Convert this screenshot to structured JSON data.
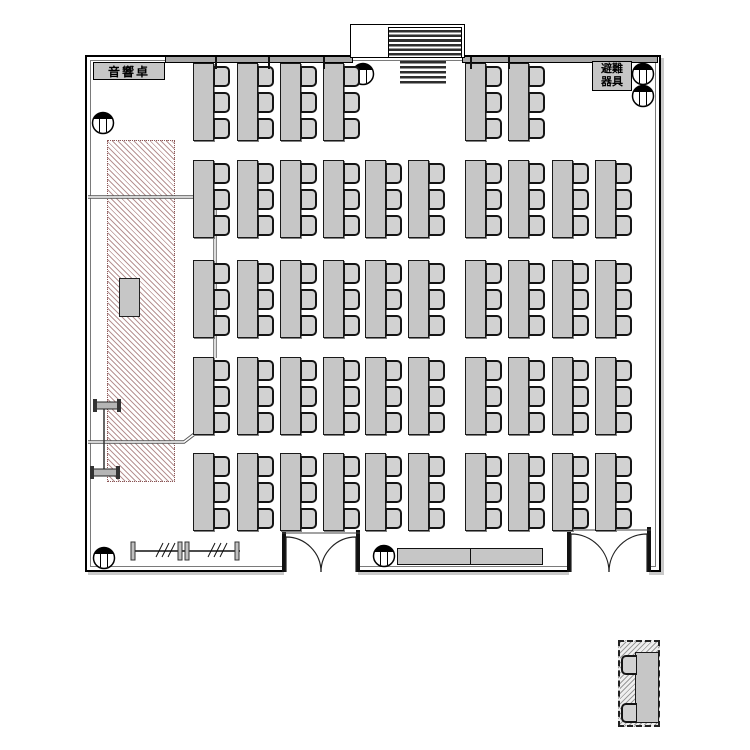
{
  "labels": {
    "sound_console": "音響卓",
    "evacuation_line1": "避難",
    "evacuation_line2": "器具"
  },
  "colors": {
    "background": "#ffffff",
    "wall": "#000000",
    "inner_wall": "#7a7a7a",
    "table_fill": "#c6c6c6",
    "chair_fill": "#d2d2d2",
    "partition_band": "#a8a8a8",
    "stage_hatch_line": "#b79494",
    "stage_hatch_border": "#8a5555",
    "legend_hatch_line": "#9a9a9a",
    "cable_line": "#555555"
  },
  "plan": {
    "table": {
      "w": 19,
      "h": 76
    },
    "chair": {
      "w": 13,
      "h": 17,
      "offsets": [
        3,
        29,
        55
      ]
    },
    "table_rows": [
      {
        "y": 63,
        "x": [
          193,
          237,
          280,
          323,
          465,
          508
        ]
      },
      {
        "y": 160,
        "x": [
          193,
          237,
          280,
          323,
          365,
          408,
          465,
          508,
          552,
          595
        ]
      },
      {
        "y": 260,
        "x": [
          193,
          237,
          280,
          323,
          365,
          408,
          465,
          508,
          552,
          595
        ]
      },
      {
        "y": 357,
        "x": [
          193,
          237,
          280,
          323,
          365,
          408,
          465,
          508,
          552,
          595
        ]
      },
      {
        "y": 453,
        "x": [
          193,
          237,
          280,
          323,
          365,
          408,
          465,
          508,
          552,
          595
        ]
      }
    ],
    "band_ticks": [
      215,
      268,
      323,
      470,
      508
    ],
    "columns": [
      [
        103,
        123
      ],
      [
        363,
        74
      ],
      [
        643,
        74
      ],
      [
        643,
        96
      ],
      [
        104,
        558
      ],
      [
        384,
        556
      ]
    ],
    "doors": [
      {
        "x1": 286,
        "x2": 356,
        "sill": 572,
        "header": 533
      },
      {
        "x1": 571,
        "x2": 647,
        "sill": 572,
        "header": 530
      }
    ],
    "cable_lines": [
      "M88 197 H193",
      "M215 201 V358",
      "M88 442 H184 L201 429"
    ],
    "ibeams": [
      {
        "x": 96,
        "y": 402,
        "w": 22,
        "h": 7
      },
      {
        "x": 93,
        "y": 469,
        "w": 24,
        "h": 7
      }
    ],
    "ibeam_connector": "M104 409 V469",
    "track": {
      "y": 551,
      "x1": 133,
      "x2": 240,
      "posts": [
        133,
        180,
        187,
        237
      ],
      "slashes": [
        160,
        212
      ]
    },
    "legend": {
      "chair_x": 621,
      "chairs_y": [
        655,
        703
      ]
    }
  }
}
